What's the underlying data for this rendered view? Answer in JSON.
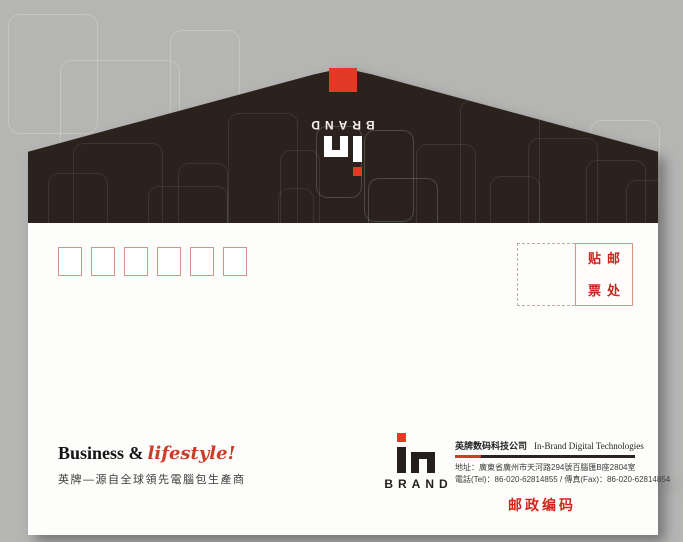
{
  "envelope": {
    "flap": {
      "brand_text": "BRAND"
    },
    "stamp_area": {
      "chars": [
        "贴",
        "邮",
        "票",
        "处"
      ]
    },
    "postal_boxes": {
      "count": 6
    },
    "tagline": {
      "english_black": "Business &",
      "english_red": "lifestyle!",
      "chinese": "英牌—源自全球領先電腦包生產商"
    },
    "logo": {
      "brand_text": "BRAND"
    },
    "company": {
      "name_cn": "英牌数码科技公司",
      "name_en": "In-Brand Digital Technologies",
      "address": "地址：廣東省廣州市天河路294號百腦匯B座2804室",
      "phone": "電話(Tel)：86-020-62814855 / 傳真(Fax)：86-020-62814854"
    },
    "postal_code_label": "邮政编码"
  },
  "colors": {
    "accent_red": "#e23a25",
    "text_red": "#c8231c",
    "flap_dark": "#2b211d",
    "background_gray": "#b5b5b4",
    "paper_white": "#fdfdfb"
  }
}
